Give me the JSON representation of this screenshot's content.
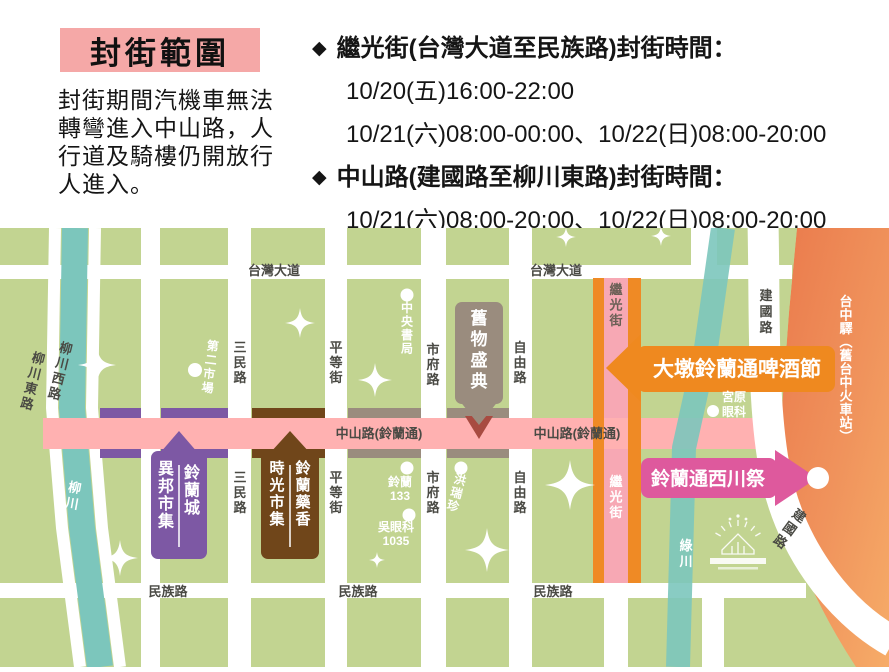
{
  "header": {
    "title": "封街範圍",
    "note": "封街期間汽機車無法轉彎進入中山路，人行道及騎樓仍開放行人進入。",
    "bullet_icon": "◆",
    "bullets": [
      {
        "heading": "繼光街(台灣大道至民族路)封街時間：",
        "times": [
          "10/20(五)16:00-22:00",
          "10/21(六)08:00-00:00、10/22(日)08:00-20:00"
        ]
      },
      {
        "heading": "中山路(建國路至柳川東路)封街時間：",
        "times": [
          "10/21(六)08:00-20:00、10/22(日)08:00-20:00"
        ]
      }
    ]
  },
  "map": {
    "roads": {
      "taiwan_blvd": "台灣大道",
      "minzu_rd": "民族路",
      "zhongshan_rd": "中山路(鈴蘭通)",
      "sanmin_rd": "三民路",
      "pingdeng_st": "平等街",
      "shifu_rd": "市府路",
      "ziyou_rd": "自由路",
      "jiguang_st": "繼光街",
      "jianguo_rd": "建國路",
      "liuchuan_e_rd": "柳川東路",
      "liuchuan_w_rd": "柳川西路"
    },
    "rivers": {
      "liuchuan": "柳川",
      "lyuchuan": "綠川"
    },
    "station": {
      "label": "台中驛︵舊台中火車站︶"
    },
    "events": {
      "beer_fest": "大墩鈴蘭通啤酒節",
      "west_river_fest": "鈴蘭通西川祭",
      "vintage_fair": "舊物盛典",
      "exotic_market_col_right": "鈴蘭城",
      "exotic_market_col_left": "異邦市集",
      "time_market_col_right": "鈴蘭藥香",
      "time_market_col_left": "時光市集"
    },
    "pois": {
      "second_market": "第二市場",
      "central_bookstore": "中央書局",
      "suzuran133_line1": "鈴蘭",
      "suzuran133_line2": "133",
      "wu_eye_line1": "吳眼科",
      "wu_eye_line2": "1035",
      "hong_rui_zhen": "洪瑞珍",
      "miyahara_line1": "宮原",
      "miyahara_line2": "眼科"
    },
    "colors": {
      "map_green": "#C2D491",
      "closure_pink": "#FFB1B1",
      "jiguang_orange": "#EF8A25",
      "purple_market": "#7D58A4",
      "brown_market": "#70461A",
      "taupe_fair": "#9A8C7E",
      "maroon_tip": "#A84B41",
      "magenta_fest": "#DE599D",
      "river_teal": "#7CC6BC",
      "station_orange": "#EE8A58",
      "title_pink": "#F5A8A7"
    }
  }
}
